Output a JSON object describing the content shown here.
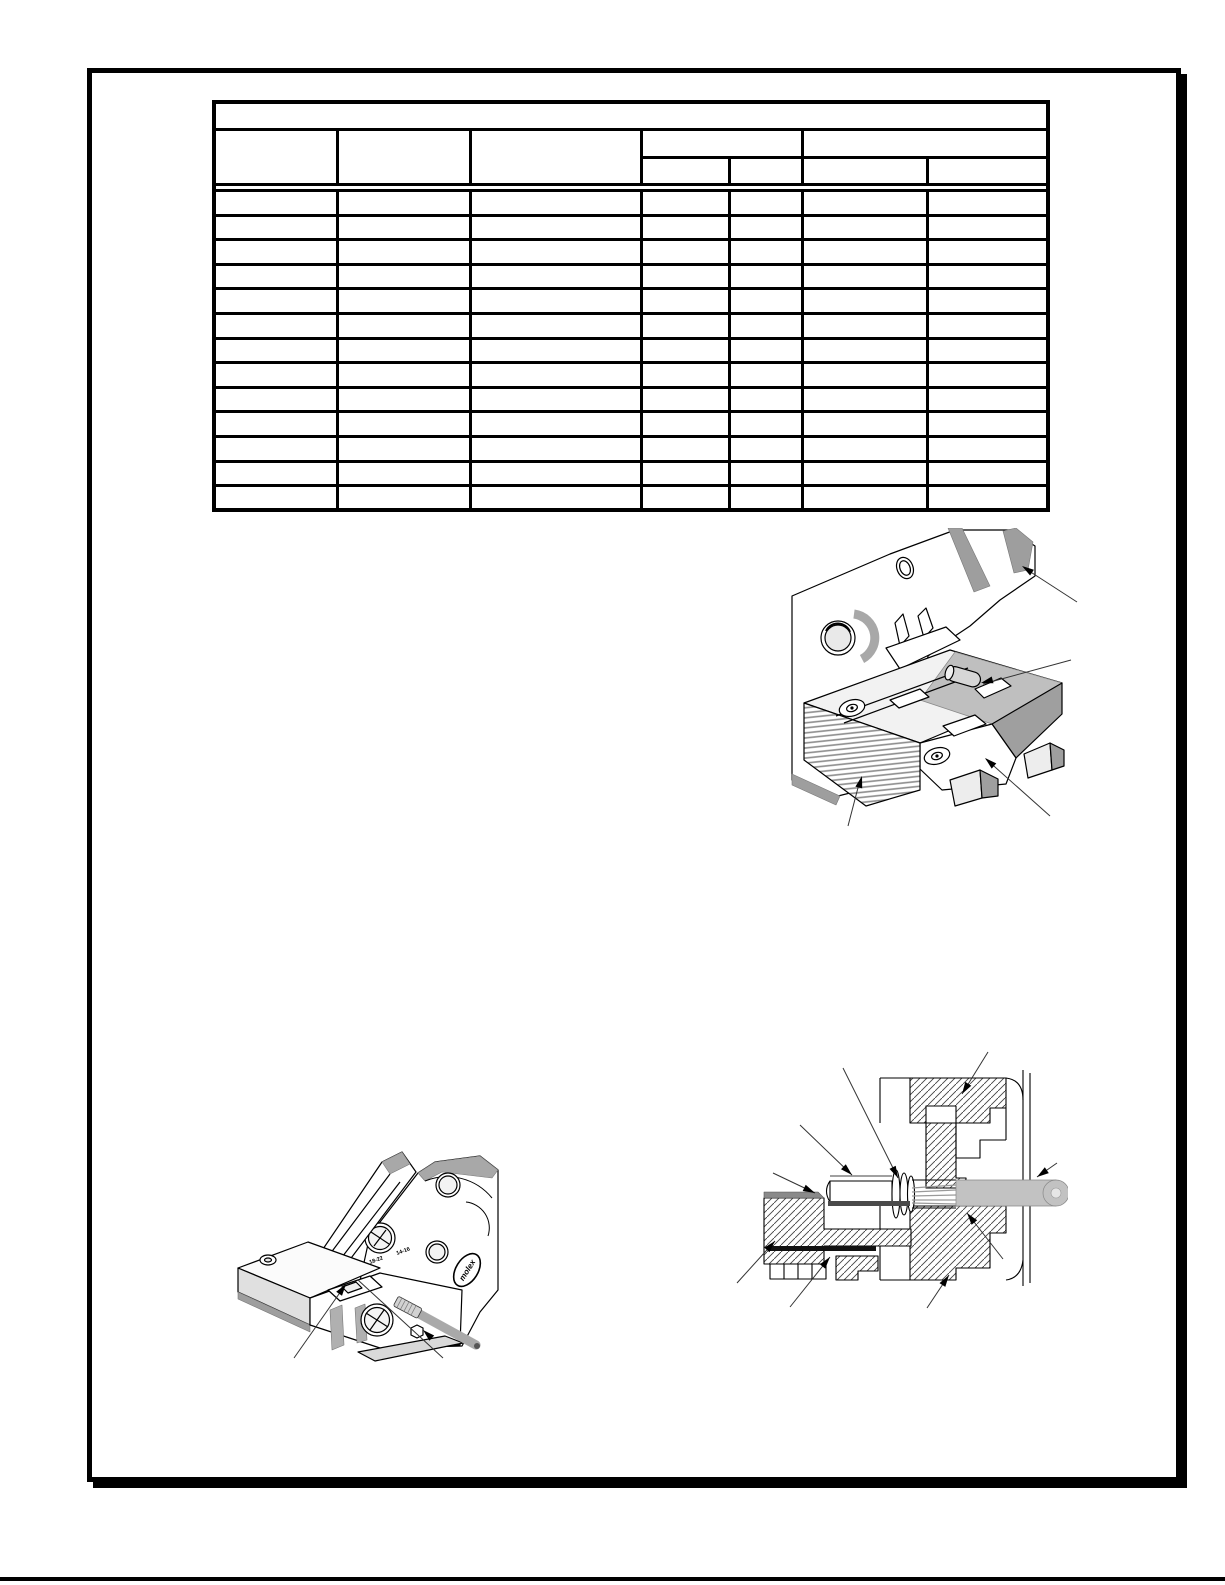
{
  "table": {
    "title": "",
    "column_headers": [
      "",
      "",
      ""
    ],
    "group_headers": [
      "",
      ""
    ],
    "sub_headers": [
      "",
      "",
      "",
      ""
    ],
    "rows": [
      [
        "",
        "",
        "",
        "",
        "",
        "",
        ""
      ],
      [
        "",
        "",
        "",
        "",
        "",
        "",
        ""
      ],
      [
        "",
        "",
        "",
        "",
        "",
        "",
        ""
      ],
      [
        "",
        "",
        "",
        "",
        "",
        "",
        ""
      ],
      [
        "",
        "",
        "",
        "",
        "",
        "",
        ""
      ],
      [
        "",
        "",
        "",
        "",
        "",
        "",
        ""
      ],
      [
        "",
        "",
        "",
        "",
        "",
        "",
        ""
      ],
      [
        "",
        "",
        "",
        "",
        "",
        "",
        ""
      ],
      [
        "",
        "",
        "",
        "",
        "",
        "",
        ""
      ],
      [
        "",
        "",
        "",
        "",
        "",
        "",
        ""
      ],
      [
        "",
        "",
        "",
        "",
        "",
        "",
        ""
      ],
      [
        "",
        "",
        "",
        "",
        "",
        "",
        ""
      ],
      [
        "",
        "",
        "",
        "",
        "",
        "",
        ""
      ]
    ]
  },
  "figures": {
    "hand_tool": {
      "logo_text": "molex",
      "nest_marking_left": "18-22",
      "nest_marking_right": "14-16"
    }
  },
  "colors": {
    "line": "#000000",
    "light_gray": "#d4d4d4",
    "mid_gray": "#a8a8a8",
    "dark_gray": "#555555",
    "wire_gray": "#c2c2c2"
  }
}
